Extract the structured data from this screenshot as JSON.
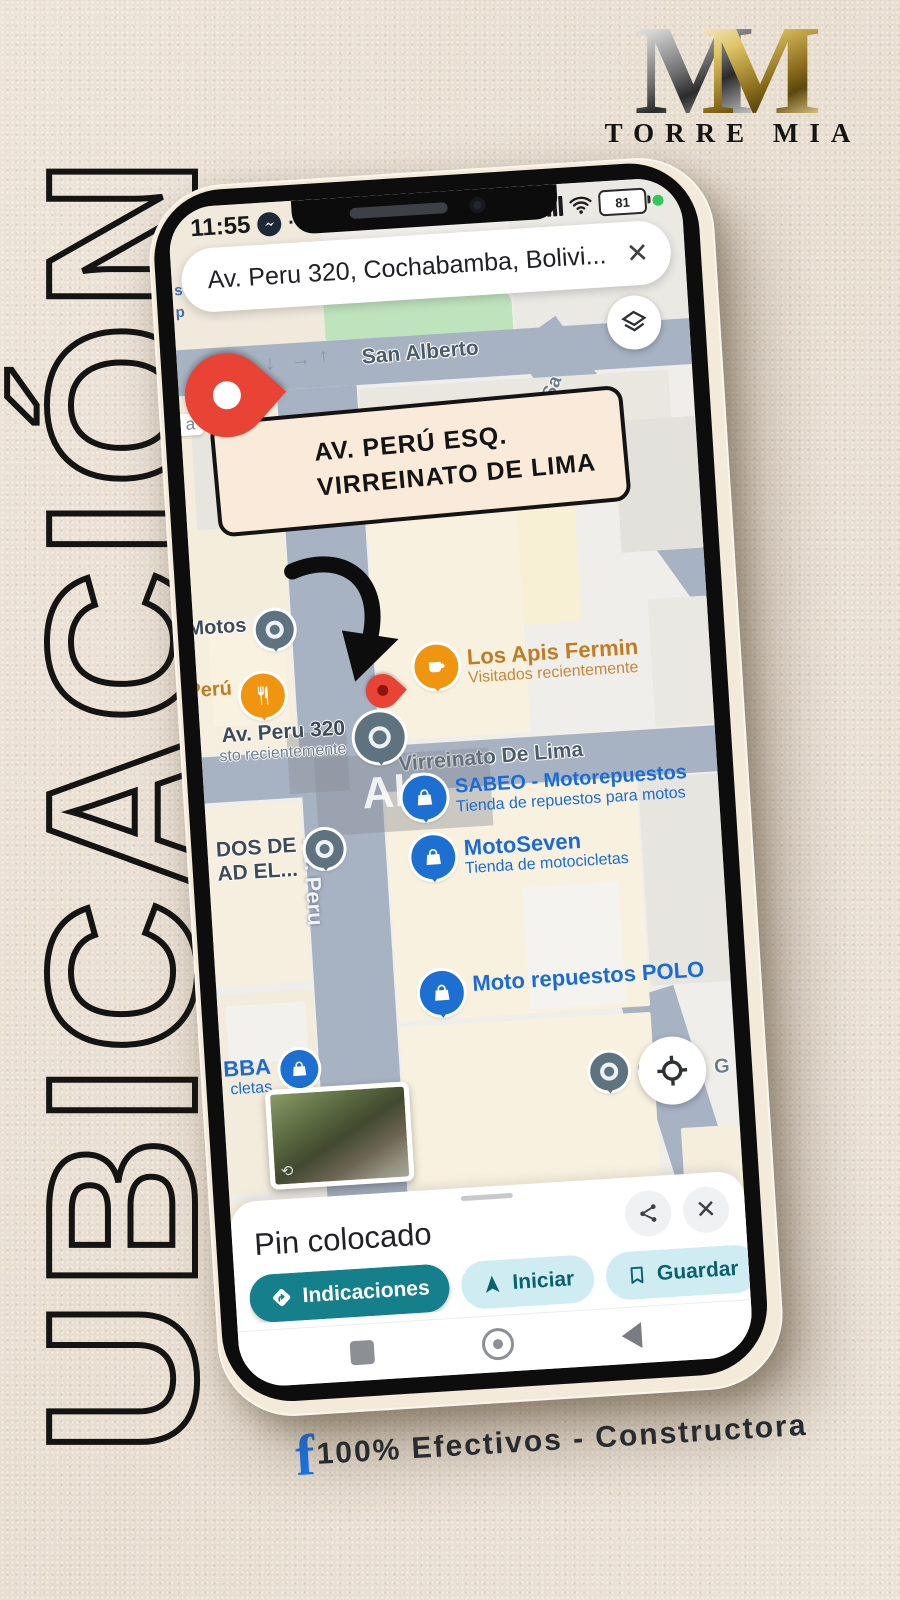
{
  "side_title": {
    "text": "UBICACIÓN"
  },
  "brand": {
    "m1": "M",
    "m2": "M",
    "name": "TORRE MIA"
  },
  "phone": {
    "status": {
      "time": "11:55",
      "more": "··",
      "battery_percent": "81"
    },
    "search": {
      "value": "Av. Peru 320, Cochabamba, Bolivi...",
      "close": "✕"
    },
    "map": {
      "streets": {
        "san_alberto": "San Alberto",
        "virreinato": "Virreinato De Lima",
        "av_peru": "Av. Peru",
        "side_street": "Sa"
      },
      "arrows": {
        "down": "↓",
        "right": "→",
        "up": "↑"
      },
      "fragments": {
        "top1": "s v",
        "top2": "p",
        "chip": "a",
        "right_g": "G"
      },
      "watermark": "Alfa",
      "callout": {
        "line1": "AV. PERÚ ESQ.",
        "line2": "VIRREINATO DE LIMA"
      },
      "pois": {
        "motos": {
          "name": "Motos"
        },
        "peru_rest": {
          "name": "Perú"
        },
        "av_peru_320": {
          "name": "Av. Peru 320",
          "sub": "sto recientemente"
        },
        "los_apis": {
          "name": "Los Apis Fermin",
          "sub": "Visitados recientemente"
        },
        "sabeo": {
          "name": "SABEO - Motorepuestos",
          "sub": "Tienda de repuestos para motos"
        },
        "motoseven": {
          "name": "MotoSeven",
          "sub": "Tienda de motocicletas"
        },
        "polo": {
          "name": "Moto repuestos POLO"
        },
        "bba": {
          "name": "BBA",
          "sub": "cletas"
        },
        "dos_de": {
          "name": "DOS DE",
          "sub": "AD EL..."
        },
        "ci": {
          "name": "Ci"
        }
      }
    },
    "sheet": {
      "title": "Pin colocado",
      "directions_label": "Indicaciones",
      "start_label": "Iniciar",
      "save_label": "Guardar",
      "close": "✕"
    }
  },
  "footer": {
    "icon": "f",
    "text": "100% Efectivos - Constructora"
  },
  "colors": {
    "accent_teal": "#15808b",
    "chip_light": "#cfecf2",
    "map_road": "#a7b2c3",
    "poi_blue": "#1a6bd8",
    "pin_red": "#e94335",
    "facebook_blue": "#1877f2",
    "background": "#e9e0d3"
  }
}
